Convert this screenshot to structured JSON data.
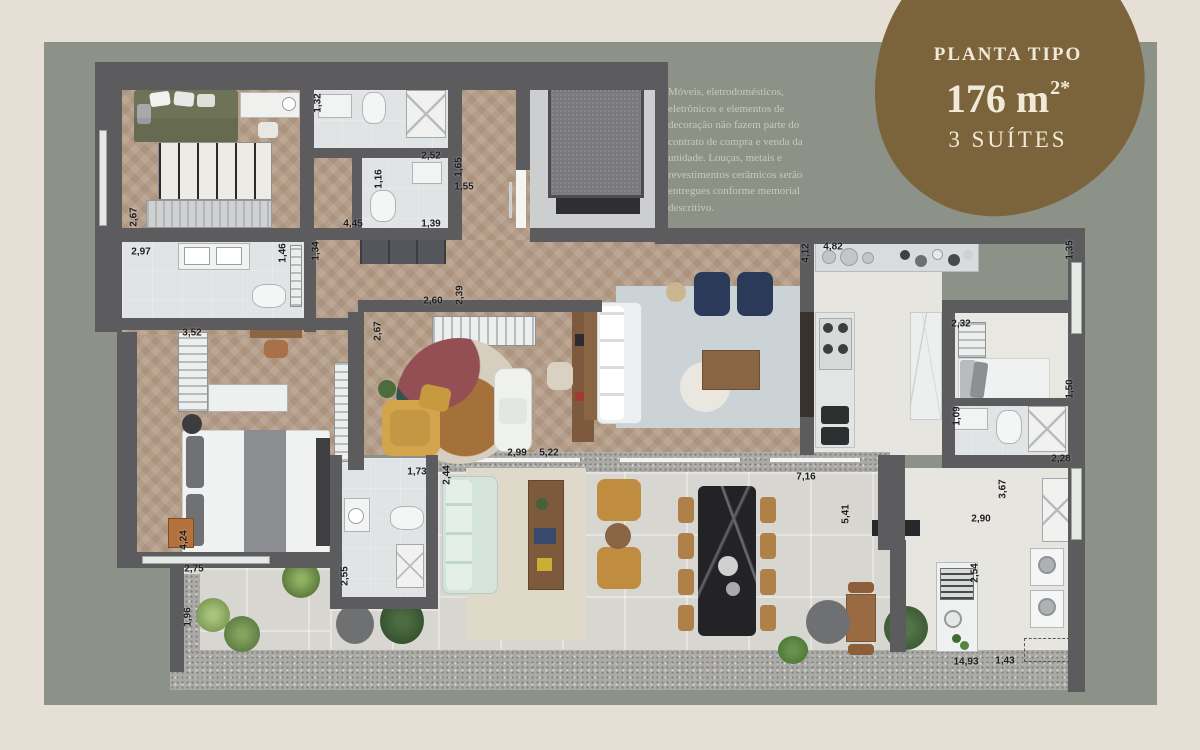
{
  "page": {
    "background_color": "#e5dfd5"
  },
  "panel": {
    "background_color": "#8d9288"
  },
  "badge": {
    "background_color": "#7b633c",
    "text_color": "#f1ead9",
    "title": "PLANTA TIPO",
    "area_main": "176 m",
    "area_superscript": "2*",
    "subtitle": "3 SUÍTES"
  },
  "disclaimer": {
    "text": "Móveis, eletrodomésticos, eletrônicos e elementos de decoração não fazem parte do contrato de compra e venda da unidade. Louças, metais e revestimentos cerâmicos serão entregues conforme memorial descritivo.",
    "text_color": "#cac8ba"
  },
  "plan": {
    "wall_color": "#5c5b5e",
    "wood_floor_color": "#b49d88",
    "tile_floor_color": "#e0e4e5",
    "terrace_floor_color": "#d8d6d0",
    "dimension_unit": "m",
    "dimensions": [
      {
        "label": "2,67",
        "x": 134,
        "y": 217,
        "vertical": true
      },
      {
        "label": "2,97",
        "x": 141,
        "y": 252,
        "vertical": false
      },
      {
        "label": "1,32",
        "x": 318,
        "y": 103,
        "vertical": true
      },
      {
        "label": "2,52",
        "x": 431,
        "y": 156,
        "vertical": false
      },
      {
        "label": "1,65",
        "x": 459,
        "y": 167,
        "vertical": true
      },
      {
        "label": "1,16",
        "x": 379,
        "y": 179,
        "vertical": true
      },
      {
        "label": "1,55",
        "x": 464,
        "y": 187,
        "vertical": false
      },
      {
        "label": "1,39",
        "x": 431,
        "y": 224,
        "vertical": false
      },
      {
        "label": "4,45",
        "x": 353,
        "y": 224,
        "vertical": false
      },
      {
        "label": "1,46",
        "x": 283,
        "y": 253,
        "vertical": true
      },
      {
        "label": "1,34",
        "x": 316,
        "y": 251,
        "vertical": true
      },
      {
        "label": "2,60",
        "x": 433,
        "y": 301,
        "vertical": false
      },
      {
        "label": "2,39",
        "x": 460,
        "y": 295,
        "vertical": true
      },
      {
        "label": "2,67",
        "x": 378,
        "y": 331,
        "vertical": true
      },
      {
        "label": "3,52",
        "x": 192,
        "y": 333,
        "vertical": false
      },
      {
        "label": "4,24",
        "x": 184,
        "y": 540,
        "vertical": true
      },
      {
        "label": "2,75",
        "x": 194,
        "y": 569,
        "vertical": false
      },
      {
        "label": "1,96",
        "x": 188,
        "y": 617,
        "vertical": true
      },
      {
        "label": "1,73",
        "x": 417,
        "y": 472,
        "vertical": false
      },
      {
        "label": "2,44",
        "x": 447,
        "y": 475,
        "vertical": true
      },
      {
        "label": "2,55",
        "x": 345,
        "y": 576,
        "vertical": true
      },
      {
        "label": "2,99",
        "x": 517,
        "y": 453,
        "vertical": false
      },
      {
        "label": "5,22",
        "x": 549,
        "y": 453,
        "vertical": false
      },
      {
        "label": "4,12",
        "x": 806,
        "y": 253,
        "vertical": true
      },
      {
        "label": "4,82",
        "x": 833,
        "y": 247,
        "vertical": false
      },
      {
        "label": "1,35",
        "x": 1070,
        "y": 250,
        "vertical": true
      },
      {
        "label": "2,32",
        "x": 961,
        "y": 324,
        "vertical": false
      },
      {
        "label": "1,50",
        "x": 1070,
        "y": 389,
        "vertical": true
      },
      {
        "label": "1,09",
        "x": 957,
        "y": 416,
        "vertical": true
      },
      {
        "label": "7,16",
        "x": 806,
        "y": 477,
        "vertical": false
      },
      {
        "label": "2,28",
        "x": 1061,
        "y": 459,
        "vertical": false
      },
      {
        "label": "3,67",
        "x": 1003,
        "y": 489,
        "vertical": true
      },
      {
        "label": "2,90",
        "x": 981,
        "y": 519,
        "vertical": false
      },
      {
        "label": "5,41",
        "x": 846,
        "y": 514,
        "vertical": true
      },
      {
        "label": "2,54",
        "x": 975,
        "y": 573,
        "vertical": true
      },
      {
        "label": "14,93",
        "x": 966,
        "y": 662,
        "vertical": false
      },
      {
        "label": "1,43",
        "x": 1005,
        "y": 661,
        "vertical": false
      }
    ]
  }
}
